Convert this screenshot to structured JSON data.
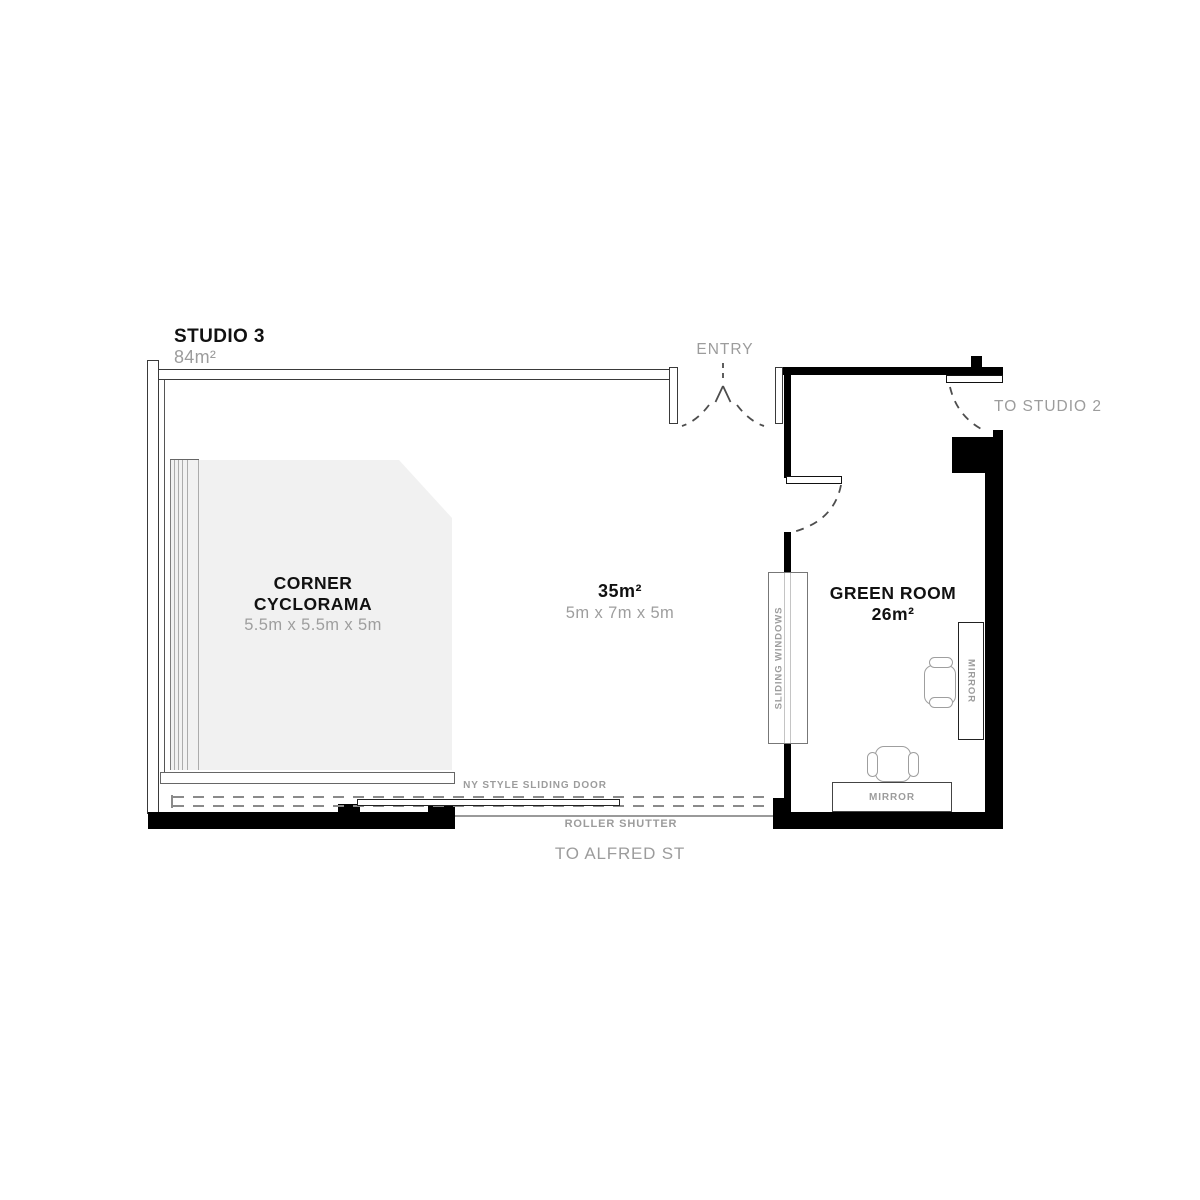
{
  "studio": {
    "title": "STUDIO 3",
    "area": "84m²"
  },
  "entry_label": "ENTRY",
  "to_studio_2": "TO STUDIO 2",
  "to_alfred_st": "TO ALFRED ST",
  "cyclorama": {
    "title_line1": "CORNER",
    "title_line2": "CYCLORAMA",
    "dimensions": "5.5m x 5.5m x 5m"
  },
  "main_area": {
    "area": "35m²",
    "dimensions": "5m x 7m x 5m"
  },
  "green_room": {
    "title": "GREEN ROOM",
    "area": "26m²",
    "sliding_windows_label": "SLIDING WINDOWS",
    "mirror_side_label": "MIRROR",
    "mirror_bottom_label": "MIRROR"
  },
  "openings": {
    "ny_sliding_door_label": "NY STYLE SLIDING DOOR",
    "roller_shutter_label": "ROLLER SHUTTER"
  },
  "colors": {
    "wall_black": "#000000",
    "text_dark": "#111111",
    "text_gray": "#9c9c9c",
    "cyclorama_fill": "#f1f1f1",
    "dash_gray": "#8a8a8a"
  }
}
